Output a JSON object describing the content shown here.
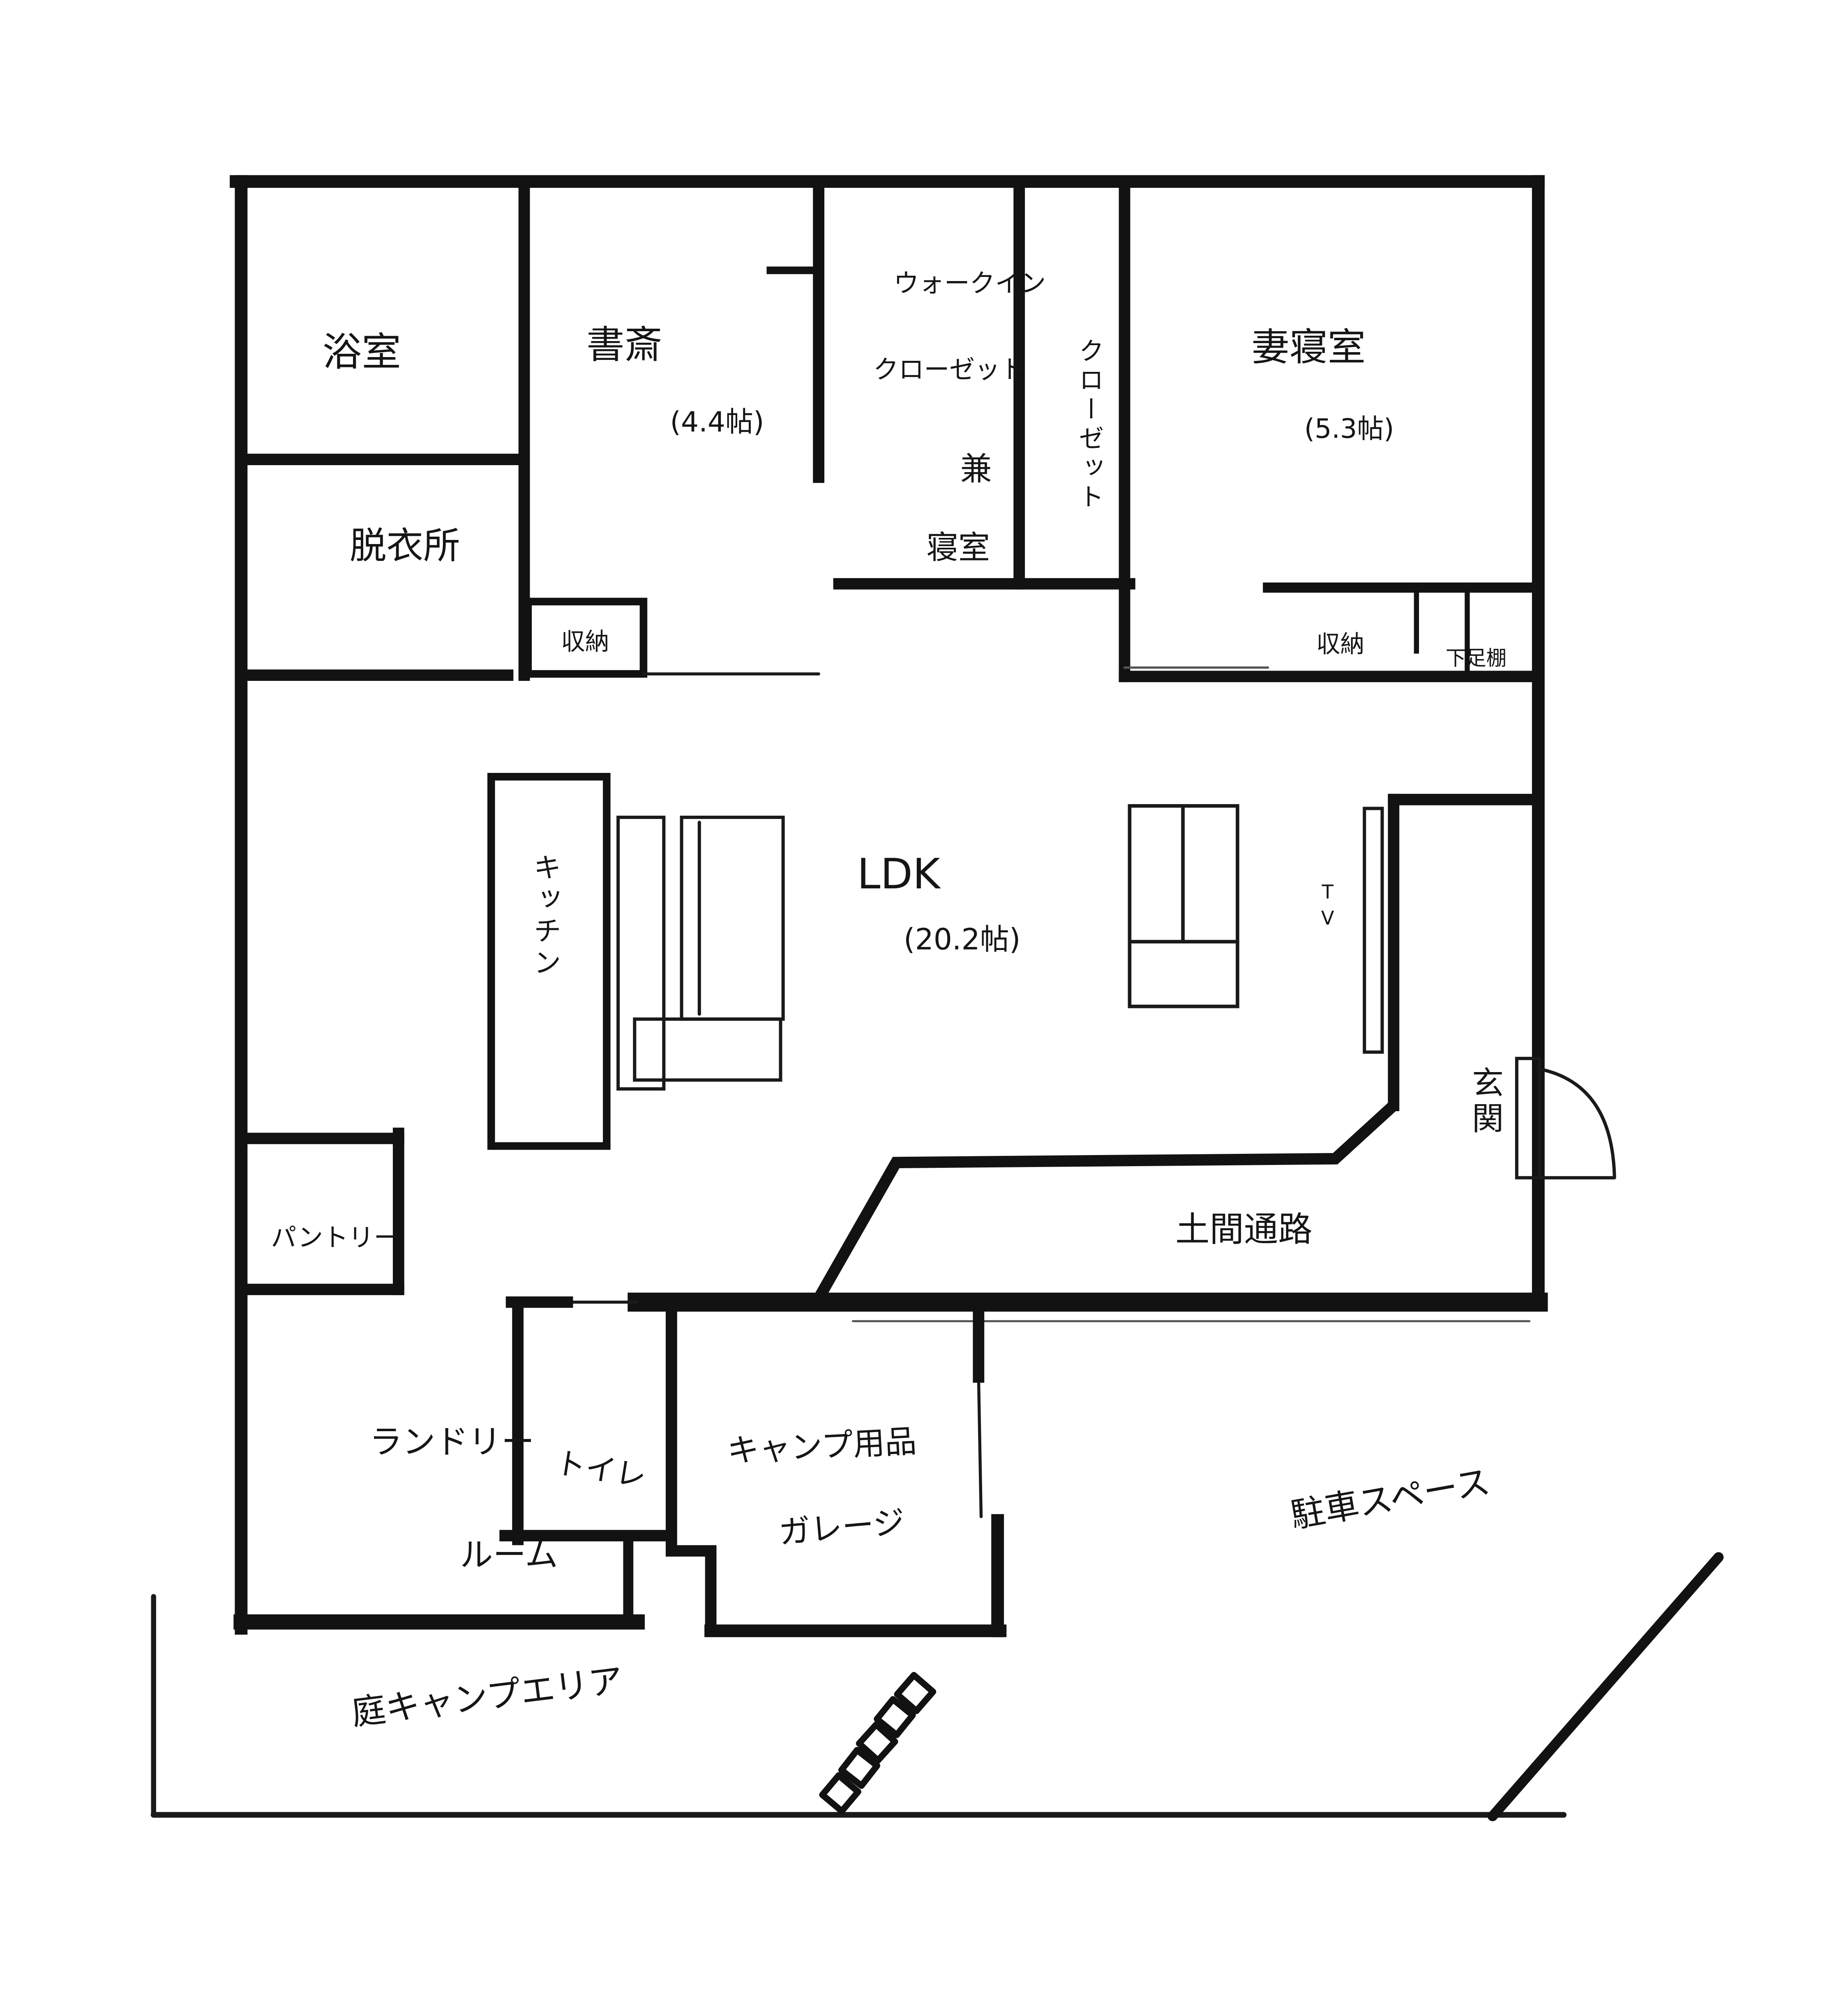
{
  "plan": {
    "type": "hand-drawn-floor-plan",
    "colors": {
      "ink": "#121212",
      "paper": "#ffffff"
    },
    "rooms": {
      "bathroom": {
        "label": "浴室"
      },
      "dressing": {
        "label": "脱衣所"
      },
      "study": {
        "label": "書斎",
        "size": "(4.4帖)"
      },
      "wic": {
        "line1": "ウォークイン",
        "line2": "クローゼット",
        "line3": "兼",
        "line4": "寝室"
      },
      "closet": {
        "label": "クローゼット"
      },
      "master": {
        "label": "妻寝室",
        "size": "(5.3帖)"
      },
      "storage_study": {
        "label": "収納"
      },
      "storage_master": {
        "label": "収納"
      },
      "shoe_shelf": {
        "label": "下足棚"
      },
      "kitchen": {
        "label": "キッチン"
      },
      "ldk": {
        "label": "LDK",
        "size": "(20.2帖)"
      },
      "tv": {
        "label": "TV"
      },
      "entrance": {
        "label": "玄関"
      },
      "pantry": {
        "label": "パントリー"
      },
      "doma": {
        "label": "土間通路"
      },
      "laundry": {
        "line1": "ランドリー",
        "line2": "ルーム"
      },
      "toilet": {
        "label": "トイレ"
      },
      "garage": {
        "line1": "キャンプ用品",
        "line2": "ガレージ"
      },
      "parking": {
        "label": "駐車スペース"
      },
      "yard": {
        "label": "庭キャンプエリア"
      }
    }
  }
}
